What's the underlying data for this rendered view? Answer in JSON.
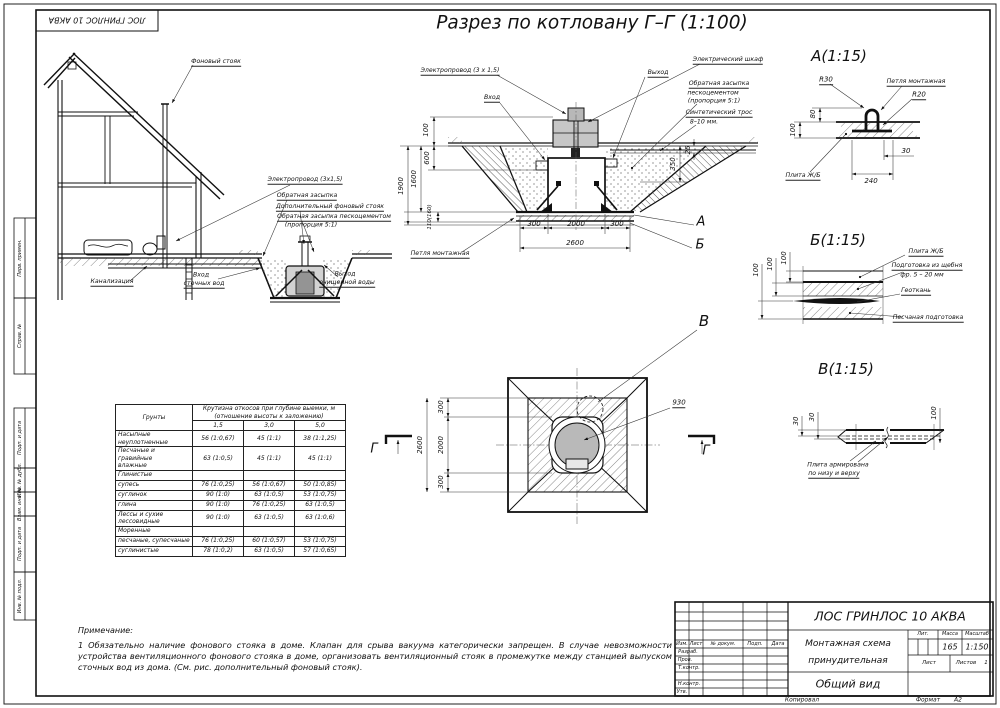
{
  "sheet": {
    "stamp_top_left": "ЛОС ГРИНЛОС 10 АКВА",
    "margin": {
      "perv": "Перв. примен.",
      "sprav": "Справ. №",
      "podp1": "Подп. и дата",
      "inv_dubl": "Инв. № дубл.",
      "vzam": "Взам. инв. №",
      "podp2": "Подп. и дата",
      "inv_podl": "Инв. № подл."
    }
  },
  "main_title": "Разрез по котловану Г–Г (1:100)",
  "house": {
    "labels": {
      "riser": "Фоновый стояк",
      "wire": "Электропровод (3х1,5)",
      "backfill": "Обратная засыпка",
      "extra_riser": "Дополнительный фоновый стояк",
      "backfill_cement": "Обратная засыпка пескоцементом",
      "proportion": "(пропорция 5:1)",
      "sewer": "Канализация",
      "inlet1": "Вход",
      "inlet2": "сточных вод",
      "outlet1": "Выход",
      "outlet2": "очищенной воды"
    }
  },
  "section": {
    "labels": {
      "cabinet": "Электрический шкаф",
      "outlet": "Выход",
      "inlet": "Вход",
      "wire": "Электропровод (3 х 1,5)",
      "backfill1": "Обратная засыпка",
      "backfill2": "пескоцементом",
      "backfill3": "(пропорция 5:1)",
      "rope1": "Синтетический трос",
      "rope2": "8–10 мм.",
      "loop": "Петля монтажная"
    },
    "dims": {
      "h100": "100",
      "h600": "600",
      "h1600": "1600",
      "h1900": "1900",
      "slab": "110(160)",
      "r350": "350",
      "r25": "25",
      "b300l": "300",
      "b2000": "2000",
      "b300r": "300",
      "b2600": "2600"
    },
    "markers": {
      "a": "А",
      "b": "Б"
    }
  },
  "detail_a": {
    "title": "А(1:15)",
    "labels": {
      "r30": "R30",
      "r20": "R20",
      "loop": "Петля монтажная",
      "plate": "Плита Ж/Б"
    },
    "dims": {
      "d80": "80",
      "d100": "100",
      "d240": "240",
      "d30": "30"
    }
  },
  "detail_b": {
    "title": "Б(1:15)",
    "labels": {
      "plate": "Плита Ж/Б",
      "gravel1": "Подготовка из щебня",
      "gravel2": "фр. 5 – 20 мм",
      "geo": "Геоткань",
      "sand": "Песчаная подготовка"
    },
    "dims": {
      "d100a": "100",
      "d100b": "100",
      "d100c": "100"
    }
  },
  "detail_v": {
    "title": "В(1:15)",
    "labels": {
      "plate1": "Плита армирована",
      "plate2": "по низу и верху"
    },
    "dims": {
      "d30a": "30",
      "d30b": "30",
      "d100": "100"
    }
  },
  "plan": {
    "markers": {
      "v": "В",
      "g_left": "Г",
      "g_right": "Г"
    },
    "dims": {
      "v300t": "300",
      "v2000": "2000",
      "v300b": "300",
      "v2600": "2600",
      "dia": "930"
    }
  },
  "soil_table": {
    "col0": "Грунты",
    "span1": "Крутизна откосов при глубине выемки, м",
    "span2": "(отношение высоты к заложению)",
    "d1": "1,5",
    "d2": "3,0",
    "d3": "5,0",
    "rows": [
      {
        "l": "Насыпные неуплотненные",
        "l2": "",
        "c1": "56 (1:0,67)",
        "c2": "45 (1:1)",
        "c3": "38 (1:1,25)"
      },
      {
        "l": "Песчаные и гравийные",
        "l2": "влажные",
        "c1": "63 (1:0,5)",
        "c2": "45 (1:1)",
        "c3": "45 (1:1)"
      },
      {
        "l": "Глинистые",
        "l2": "",
        "c1": "",
        "c2": "",
        "c3": ""
      },
      {
        "l": "супесь",
        "l2": "",
        "c1": "76 (1:0,25)",
        "c2": "56 (1:0,67)",
        "c3": "50 (1:0,85)"
      },
      {
        "l": "суглинок",
        "l2": "",
        "c1": "90 (1:0)",
        "c2": "63 (1:0,5)",
        "c3": "53 (1:0,75)"
      },
      {
        "l": "глина",
        "l2": "",
        "c1": "90 (1:0)",
        "c2": "76 (1:0,25)",
        "c3": "63 (1:0,5)"
      },
      {
        "l": "Лессы и сухие лессовидные",
        "l2": "",
        "c1": "90 (1:0)",
        "c2": "63 (1:0,5)",
        "c3": "63 (1:0,6)"
      },
      {
        "l": "Моренные",
        "l2": "",
        "c1": "",
        "c2": "",
        "c3": ""
      },
      {
        "l": "песчаные, супесчаные",
        "l2": "",
        "c1": "76 (1:0,25)",
        "c2": "60 (1:0,57)",
        "c3": "53 (1:0,75)"
      },
      {
        "l": "суглинистые",
        "l2": "",
        "c1": "78 (1:0,2)",
        "c2": "63 (1:0,5)",
        "c3": "57 (1:0,65)"
      }
    ]
  },
  "notes": {
    "title": "Примечание:",
    "text": "1 Обязательно наличие фонового стояка в доме. Клапан для срыва вакуума категорически запрещен. В случае невозможности устройства вентиляционного фонового стояка в доме, организовать вентиляционный стояк в промежутке между станцией выпуском сточных вод из дома. (См. рис. дополнительный фоновый стояк)."
  },
  "title_block": {
    "doc": "ЛОС ГРИНЛОС 10 АКВА",
    "name1": "Монтажная схема",
    "name2": "принудительная",
    "view": "Общий вид",
    "cols": {
      "izm": "Изм.",
      "list": "Лист",
      "doc": "№ докум.",
      "podp": "Подп.",
      "data": "Дата"
    },
    "rows": {
      "razrab": "Разраб.",
      "prov": "Пров.",
      "tkontr": "Т.контр.",
      "nkontr": "Н.контр.",
      "utv": "Утв."
    },
    "lit": "Лит.",
    "massa": "Масса",
    "masshtab": "Масштаб",
    "massa_val": "165",
    "scale_val": "1:150",
    "list": "Лист",
    "listov": "Листов",
    "listov_val": "1",
    "kopiroval": "Копировал",
    "format": "Формат",
    "format_val": "А2"
  }
}
